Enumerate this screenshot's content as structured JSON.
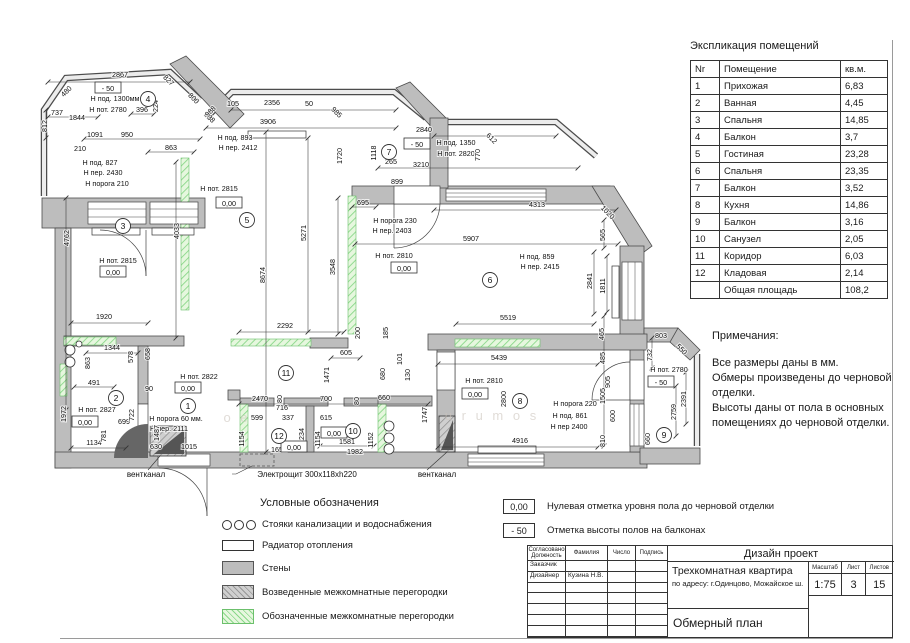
{
  "colors": {
    "wall_fill": "#bdbdbd",
    "wall_stroke": "#4c4c4c",
    "partition_green_bg": "#e6f7de",
    "partition_green_line": "#8ad88a",
    "drawing_line": "#333333"
  },
  "explication": {
    "title": "Экспликация помещений",
    "headers": [
      "Nr",
      "Помещение",
      "кв.м."
    ],
    "rows": [
      {
        "nr": "1",
        "name": "Прихожая",
        "area": "6,83"
      },
      {
        "nr": "2",
        "name": "Ванная",
        "area": "4,45"
      },
      {
        "nr": "3",
        "name": "Спальня",
        "area": "14,85"
      },
      {
        "nr": "4",
        "name": "Балкон",
        "area": "3,7"
      },
      {
        "nr": "5",
        "name": "Гостиная",
        "area": "23,28"
      },
      {
        "nr": "6",
        "name": "Спальня",
        "area": "23,35"
      },
      {
        "nr": "7",
        "name": "Балкон",
        "area": "3,52"
      },
      {
        "nr": "8",
        "name": "Кухня",
        "area": "14,86"
      },
      {
        "nr": "9",
        "name": "Балкон",
        "area": "3,16"
      },
      {
        "nr": "10",
        "name": "Санузел",
        "area": "2,05"
      },
      {
        "nr": "11",
        "name": "Коридор",
        "area": "6,03"
      },
      {
        "nr": "12",
        "name": "Кладовая",
        "area": "2,14"
      }
    ],
    "total": {
      "nr": "",
      "name": "Общая площадь",
      "area": "108,2"
    }
  },
  "notes": {
    "title": "Примечания:",
    "body": "Все размеры даны в мм.\nОбмеры произведены до черновой\nотделки.\nВысоты даны от пола в основных\nпомещениях до черновой отделки."
  },
  "legend": {
    "title": "Условные обозначения",
    "items": [
      {
        "icon": "risers",
        "label": "Стояки канализации и водоснабжения"
      },
      {
        "icon": "radiator",
        "label": "Радиатор отопления"
      },
      {
        "icon": "wall",
        "label": "Стены"
      },
      {
        "icon": "built",
        "label": "Возведенные межкомнатные перегородки"
      },
      {
        "icon": "marked",
        "label": "Обозначенные межкомнатные перегородки"
      }
    ]
  },
  "marks": [
    {
      "value": "0,00",
      "label": "Нулевая отметка уровня пола до черновой отделки"
    },
    {
      "value": "- 50",
      "label": "Отметка высоты полов на балконах"
    }
  ],
  "titleblock": {
    "project_type": "Дизайн проект",
    "object": "Трехкомнатная квартира",
    "address": "по адресу: г.Одинцово, Можайское ш.",
    "drawing": "Обмерный план",
    "scale_label": "Масштаб",
    "scale": "1:75",
    "sheet_label": "Лист",
    "sheet": "3",
    "sheets_label": "Листов",
    "sheets": "15",
    "col_headers": [
      "Согласовано\nДолжность",
      "Фамилия",
      "Число",
      "Подпись"
    ],
    "rows": [
      [
        "Заказчик",
        "",
        "",
        ""
      ],
      [
        "Дизайнер",
        "Кузина Н.В.",
        "",
        ""
      ]
    ]
  },
  "plan": {
    "texts": [
      {
        "t": "2867",
        "x": 120,
        "y": 77
      },
      {
        "t": "737",
        "x": 57,
        "y": 115
      },
      {
        "t": "1844",
        "x": 77,
        "y": 120
      },
      {
        "t": "396",
        "x": 142,
        "y": 112
      },
      {
        "t": "1091",
        "x": 95,
        "y": 137
      },
      {
        "t": "950",
        "x": 127,
        "y": 137
      },
      {
        "t": "210",
        "x": 80,
        "y": 151
      },
      {
        "t": "863",
        "x": 171,
        "y": 150
      },
      {
        "t": "105",
        "x": 233,
        "y": 106
      },
      {
        "t": "2356",
        "x": 272,
        "y": 105
      },
      {
        "t": "50",
        "x": 309,
        "y": 106
      },
      {
        "t": "3906",
        "x": 268,
        "y": 124
      },
      {
        "t": "2840",
        "x": 424,
        "y": 132
      },
      {
        "t": "265",
        "x": 391,
        "y": 164
      },
      {
        "t": "3210",
        "x": 421,
        "y": 167
      },
      {
        "t": "899",
        "x": 397,
        "y": 184
      },
      {
        "t": "695",
        "x": 363,
        "y": 205
      },
      {
        "t": "4313",
        "x": 537,
        "y": 207
      },
      {
        "t": "5907",
        "x": 471,
        "y": 241
      },
      {
        "t": "5519",
        "x": 508,
        "y": 320
      },
      {
        "t": "5439",
        "x": 499,
        "y": 360
      },
      {
        "t": "2292",
        "x": 285,
        "y": 328
      },
      {
        "t": "1920",
        "x": 104,
        "y": 319
      },
      {
        "t": "605",
        "x": 346,
        "y": 355
      },
      {
        "t": "1344",
        "x": 112,
        "y": 350
      },
      {
        "t": "491",
        "x": 94,
        "y": 385
      },
      {
        "t": "90",
        "x": 149,
        "y": 391
      },
      {
        "t": "2470",
        "x": 260,
        "y": 401
      },
      {
        "t": "699",
        "x": 124,
        "y": 424
      },
      {
        "t": "599",
        "x": 257,
        "y": 420
      },
      {
        "t": "716",
        "x": 282,
        "y": 410
      },
      {
        "t": "337",
        "x": 288,
        "y": 420
      },
      {
        "t": "700",
        "x": 326,
        "y": 401
      },
      {
        "t": "615",
        "x": 326,
        "y": 420
      },
      {
        "t": "660",
        "x": 384,
        "y": 400
      },
      {
        "t": "1134",
        "x": 94,
        "y": 445
      },
      {
        "t": "630",
        "x": 156,
        "y": 449
      },
      {
        "t": "1015",
        "x": 189,
        "y": 449
      },
      {
        "t": "1652",
        "x": 279,
        "y": 452
      },
      {
        "t": "1581",
        "x": 347,
        "y": 444
      },
      {
        "t": "1982",
        "x": 355,
        "y": 454
      },
      {
        "t": "4916",
        "x": 520,
        "y": 443
      },
      {
        "t": "803",
        "x": 661,
        "y": 338
      },
      {
        "t": "Н под. 1300мм",
        "x": 115,
        "y": 101
      },
      {
        "t": "Н пот. 2780",
        "x": 108,
        "y": 112
      },
      {
        "t": "Н под. 827",
        "x": 100,
        "y": 165
      },
      {
        "t": "Н пер. 2430",
        "x": 103,
        "y": 175
      },
      {
        "t": "Н порога 210",
        "x": 107,
        "y": 186
      },
      {
        "t": "Н под. 893",
        "x": 235,
        "y": 140
      },
      {
        "t": "Н пер. 2412",
        "x": 238,
        "y": 150
      },
      {
        "t": "Н пот. 2815",
        "x": 219,
        "y": 191
      },
      {
        "t": "Н под. 1350",
        "x": 456,
        "y": 145
      },
      {
        "t": "Н пот. 2820",
        "x": 456,
        "y": 156
      },
      {
        "t": "Н порога 230",
        "x": 395,
        "y": 223
      },
      {
        "t": "Н пер. 2403",
        "x": 392,
        "y": 233
      },
      {
        "t": "Н пот. 2810",
        "x": 394,
        "y": 258
      },
      {
        "t": "Н под. 859",
        "x": 537,
        "y": 259
      },
      {
        "t": "Н пер. 2415",
        "x": 540,
        "y": 269
      },
      {
        "t": "Н пот. 2815",
        "x": 118,
        "y": 263
      },
      {
        "t": "Н пот. 2822",
        "x": 199,
        "y": 379
      },
      {
        "t": "Н пот. 2827",
        "x": 97,
        "y": 412
      },
      {
        "t": "Н порога 60 мм.",
        "x": 176,
        "y": 421
      },
      {
        "t": "Н пер. 2111",
        "x": 169,
        "y": 431
      },
      {
        "t": "Н пот. 2810",
        "x": 484,
        "y": 383
      },
      {
        "t": "Н порога 220",
        "x": 575,
        "y": 406
      },
      {
        "t": "Н под. 861",
        "x": 570,
        "y": 418
      },
      {
        "t": "Н пер 2400",
        "x": 569,
        "y": 429
      },
      {
        "t": "Н пот. 2780",
        "x": 669,
        "y": 372
      },
      {
        "t": "вентканал",
        "x": 146,
        "y": 477,
        "fs": 8
      },
      {
        "t": "Электрощит 300x118xh220",
        "x": 307,
        "y": 477,
        "fs": 8
      },
      {
        "t": "вентканал",
        "x": 437,
        "y": 477,
        "fs": 8
      },
      {
        "t": "812",
        "x": 47,
        "y": 126,
        "r": -90
      },
      {
        "t": "224",
        "x": 158,
        "y": 106,
        "r": -90
      },
      {
        "t": "1118",
        "x": 376,
        "y": 153,
        "r": -90
      },
      {
        "t": "1720",
        "x": 342,
        "y": 156,
        "r": -90
      },
      {
        "t": "770",
        "x": 480,
        "y": 155,
        "r": -90
      },
      {
        "t": "5271",
        "x": 306,
        "y": 233,
        "r": -90
      },
      {
        "t": "4033",
        "x": 179,
        "y": 231,
        "r": -90
      },
      {
        "t": "4762",
        "x": 69,
        "y": 238,
        "r": -90
      },
      {
        "t": "8674",
        "x": 265,
        "y": 275,
        "r": -90
      },
      {
        "t": "3548",
        "x": 335,
        "y": 267,
        "r": -90
      },
      {
        "t": "565",
        "x": 605,
        "y": 235,
        "r": -90
      },
      {
        "t": "2841",
        "x": 592,
        "y": 281,
        "r": -90
      },
      {
        "t": "1811",
        "x": 605,
        "y": 286,
        "r": -90
      },
      {
        "t": "465",
        "x": 604,
        "y": 334,
        "r": -90
      },
      {
        "t": "485",
        "x": 605,
        "y": 358,
        "r": -90
      },
      {
        "t": "732",
        "x": 652,
        "y": 355,
        "r": -90
      },
      {
        "t": "905",
        "x": 610,
        "y": 382,
        "r": -90
      },
      {
        "t": "1505",
        "x": 605,
        "y": 396,
        "r": -90
      },
      {
        "t": "600",
        "x": 615,
        "y": 416,
        "r": -90
      },
      {
        "t": "810",
        "x": 605,
        "y": 441,
        "r": -90
      },
      {
        "t": "660",
        "x": 650,
        "y": 439,
        "r": -90
      },
      {
        "t": "2759",
        "x": 676,
        "y": 412,
        "r": -90
      },
      {
        "t": "2391",
        "x": 686,
        "y": 399,
        "r": -90
      },
      {
        "t": "578",
        "x": 133,
        "y": 357,
        "r": -90
      },
      {
        "t": "658",
        "x": 150,
        "y": 354,
        "r": -90
      },
      {
        "t": "863",
        "x": 90,
        "y": 363,
        "r": -90
      },
      {
        "t": "1972",
        "x": 66,
        "y": 414,
        "r": -90
      },
      {
        "t": "722",
        "x": 134,
        "y": 415,
        "r": -90
      },
      {
        "t": "781",
        "x": 106,
        "y": 436,
        "r": -90
      },
      {
        "t": "1487",
        "x": 159,
        "y": 433,
        "r": -90
      },
      {
        "t": "1154",
        "x": 244,
        "y": 439,
        "r": -90
      },
      {
        "t": "1234",
        "x": 304,
        "y": 436,
        "r": -90
      },
      {
        "t": "1154",
        "x": 320,
        "y": 439,
        "r": -90
      },
      {
        "t": "1152",
        "x": 373,
        "y": 440,
        "r": -90
      },
      {
        "t": "1747",
        "x": 427,
        "y": 415,
        "r": -90
      },
      {
        "t": "2800",
        "x": 506,
        "y": 399,
        "r": -90
      },
      {
        "t": "200",
        "x": 360,
        "y": 333,
        "r": -90
      },
      {
        "t": "185",
        "x": 388,
        "y": 333,
        "r": -90
      },
      {
        "t": "101",
        "x": 402,
        "y": 359,
        "r": -90
      },
      {
        "t": "130",
        "x": 410,
        "y": 375,
        "r": -90
      },
      {
        "t": "680",
        "x": 385,
        "y": 374,
        "r": -90
      },
      {
        "t": "80",
        "x": 359,
        "y": 401,
        "r": -90
      },
      {
        "t": "80",
        "x": 282,
        "y": 399,
        "r": -90
      },
      {
        "t": "1471",
        "x": 329,
        "y": 375,
        "r": -90
      },
      {
        "t": "480",
        "x": 68,
        "y": 93,
        "r": -45
      },
      {
        "t": "827",
        "x": 167,
        "y": 82,
        "r": 45
      },
      {
        "t": "800",
        "x": 192,
        "y": 100,
        "r": 45
      },
      {
        "t": "888",
        "x": 208,
        "y": 119,
        "r": 45
      },
      {
        "t": "988",
        "x": 212,
        "y": 113,
        "r": -45
      },
      {
        "t": "985",
        "x": 335,
        "y": 114,
        "r": 45
      },
      {
        "t": "612",
        "x": 490,
        "y": 140,
        "r": 45
      },
      {
        "t": "1020",
        "x": 606,
        "y": 214,
        "r": 45
      },
      {
        "t": "550",
        "x": 680,
        "y": 351,
        "r": 45
      }
    ],
    "levels": [
      {
        "t": "- 50",
        "x": 108,
        "y": 90
      },
      {
        "t": "0,00",
        "x": 229,
        "y": 205
      },
      {
        "t": "- 50",
        "x": 417,
        "y": 146
      },
      {
        "t": "0,00",
        "x": 113,
        "y": 274
      },
      {
        "t": "0,00",
        "x": 404,
        "y": 270
      },
      {
        "t": "0,00",
        "x": 188,
        "y": 390
      },
      {
        "t": "0,00",
        "x": 85,
        "y": 424
      },
      {
        "t": "0,00",
        "x": 334,
        "y": 435
      },
      {
        "t": "0,00",
        "x": 294,
        "y": 449
      },
      {
        "t": "0,00",
        "x": 475,
        "y": 396
      },
      {
        "t": "- 50",
        "x": 661,
        "y": 384
      }
    ],
    "rooms": [
      {
        "n": "4",
        "x": 148,
        "y": 99
      },
      {
        "n": "3",
        "x": 123,
        "y": 226
      },
      {
        "n": "5",
        "x": 247,
        "y": 220
      },
      {
        "n": "7",
        "x": 389,
        "y": 152
      },
      {
        "n": "6",
        "x": 490,
        "y": 280
      },
      {
        "n": "8",
        "x": 520,
        "y": 401
      },
      {
        "n": "9",
        "x": 664,
        "y": 435
      },
      {
        "n": "2",
        "x": 116,
        "y": 398
      },
      {
        "n": "1",
        "x": 188,
        "y": 406
      },
      {
        "n": "11",
        "x": 286,
        "y": 373
      },
      {
        "n": "12",
        "x": 279,
        "y": 436
      },
      {
        "n": "10",
        "x": 353,
        "y": 431
      }
    ],
    "watermarks": [
      {
        "t": "о е",
        "x": 237,
        "y": 422
      },
      {
        "t": "u r u   m o s",
        "x": 492,
        "y": 420
      }
    ]
  }
}
